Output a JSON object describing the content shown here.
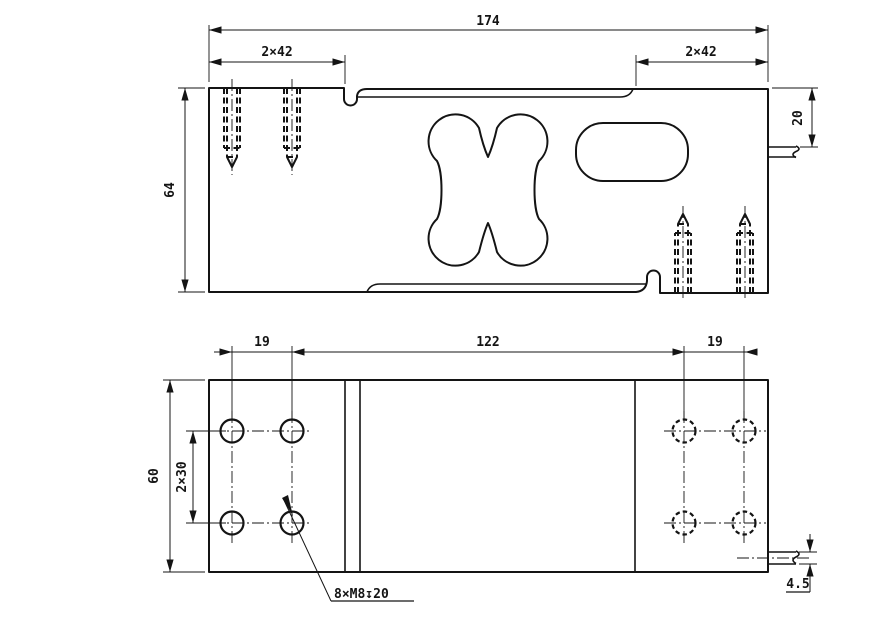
{
  "colors": {
    "ink": "#141414",
    "paper": "#ffffff"
  },
  "top_view": {
    "dim_total_length": "174",
    "dim_left_spacing": "2×42",
    "dim_right_spacing": "2×42",
    "dim_height": "64",
    "dim_cable_offset": "20"
  },
  "bottom_view": {
    "dim_left_pitch": "19",
    "dim_center_distance": "122",
    "dim_right_pitch": "19",
    "dim_width": "60",
    "dim_row_pitch": "2×30",
    "thread_callout": "8×M8↧20",
    "dim_cable_dia": "4.5"
  }
}
